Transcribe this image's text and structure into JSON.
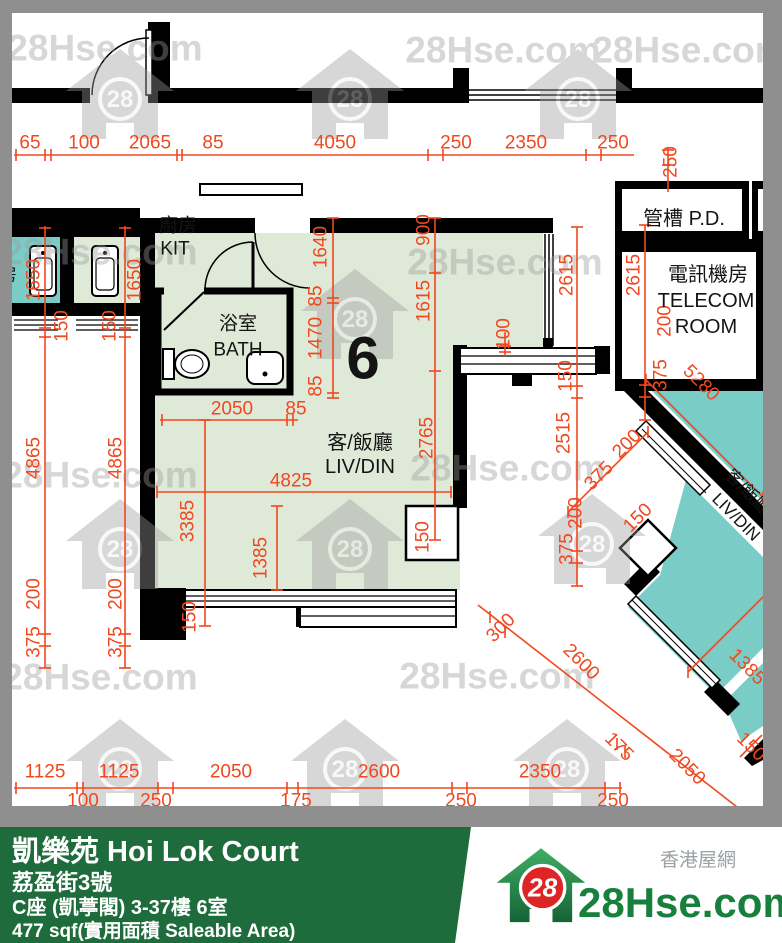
{
  "unit": {
    "number": "6"
  },
  "rooms": [
    {
      "text": "廚房",
      "x": 178,
      "y": 226,
      "size": 19
    },
    {
      "text": "KIT",
      "x": 175,
      "y": 249,
      "size": 19
    },
    {
      "text": "浴室",
      "x": 238,
      "y": 324,
      "size": 19
    },
    {
      "text": "BATH",
      "x": 238,
      "y": 350,
      "size": 19
    },
    {
      "text": "客/飯廳",
      "x": 360,
      "y": 443,
      "size": 20
    },
    {
      "text": "LIV/DIN",
      "x": 360,
      "y": 467,
      "size": 20
    },
    {
      "text": "6",
      "x": 363,
      "y": 358,
      "size": 60,
      "bold": true
    },
    {
      "text": "管槽 P.D.",
      "x": 684,
      "y": 219,
      "size": 20
    },
    {
      "text": "電訊機房",
      "x": 708,
      "y": 275,
      "size": 20
    },
    {
      "text": "TELECOM",
      "x": 706,
      "y": 301,
      "size": 20
    },
    {
      "text": "ROOM",
      "x": 706,
      "y": 327,
      "size": 20
    },
    {
      "text": "客/飯廳",
      "x": 748,
      "y": 492,
      "size": 17,
      "rot": 45
    },
    {
      "text": "LIV/DIN",
      "x": 736,
      "y": 517,
      "size": 17,
      "rot": 45
    },
    {
      "text": "房",
      "x": 8,
      "y": 275,
      "size": 18
    }
  ],
  "dimensions": [
    {
      "v": "65",
      "x": 30,
      "y": 143,
      "r": 0
    },
    {
      "v": "100",
      "x": 84,
      "y": 143,
      "r": 0
    },
    {
      "v": "2065",
      "x": 150,
      "y": 143,
      "r": 0
    },
    {
      "v": "85",
      "x": 213,
      "y": 143,
      "r": 0
    },
    {
      "v": "4050",
      "x": 335,
      "y": 143,
      "r": 0
    },
    {
      "v": "250",
      "x": 456,
      "y": 143,
      "r": 0
    },
    {
      "v": "2350",
      "x": 526,
      "y": 143,
      "r": 0
    },
    {
      "v": "250",
      "x": 613,
      "y": 143,
      "r": 0
    },
    {
      "v": "250",
      "x": 671,
      "y": 162,
      "r": -90
    },
    {
      "v": "1650",
      "x": 34,
      "y": 280,
      "r": -90
    },
    {
      "v": "150",
      "x": 62,
      "y": 326,
      "r": -90
    },
    {
      "v": "4865",
      "x": 34,
      "y": 458,
      "r": -90
    },
    {
      "v": "200",
      "x": 34,
      "y": 594,
      "r": -90
    },
    {
      "v": "375",
      "x": 34,
      "y": 642,
      "r": -90
    },
    {
      "v": "1650",
      "x": 135,
      "y": 280,
      "r": -90
    },
    {
      "v": "150",
      "x": 110,
      "y": 326,
      "r": -90
    },
    {
      "v": "4865",
      "x": 116,
      "y": 458,
      "r": -90
    },
    {
      "v": "200",
      "x": 116,
      "y": 594,
      "r": -90
    },
    {
      "v": "375",
      "x": 116,
      "y": 642,
      "r": -90
    },
    {
      "v": "1640",
      "x": 321,
      "y": 247,
      "r": -90
    },
    {
      "v": "85",
      "x": 316,
      "y": 296,
      "r": -90
    },
    {
      "v": "1470",
      "x": 316,
      "y": 338,
      "r": -90
    },
    {
      "v": "85",
      "x": 316,
      "y": 386,
      "r": -90
    },
    {
      "v": "900",
      "x": 424,
      "y": 230,
      "r": -90
    },
    {
      "v": "1615",
      "x": 424,
      "y": 301,
      "r": -90
    },
    {
      "v": "2765",
      "x": 427,
      "y": 438,
      "r": -90
    },
    {
      "v": "100",
      "x": 504,
      "y": 334,
      "r": -90
    },
    {
      "v": "2050",
      "x": 232,
      "y": 409,
      "r": 0
    },
    {
      "v": "85",
      "x": 296,
      "y": 409,
      "r": 0
    },
    {
      "v": "4825",
      "x": 291,
      "y": 481,
      "r": 0
    },
    {
      "v": "3385",
      "x": 188,
      "y": 521,
      "r": -90
    },
    {
      "v": "1385",
      "x": 261,
      "y": 558,
      "r": -90
    },
    {
      "v": "150",
      "x": 190,
      "y": 617,
      "r": -90
    },
    {
      "v": "150",
      "x": 423,
      "y": 537,
      "r": -90
    },
    {
      "v": "2615",
      "x": 567,
      "y": 275,
      "r": -90
    },
    {
      "v": "2515",
      "x": 564,
      "y": 433,
      "r": -90
    },
    {
      "v": "200",
      "x": 576,
      "y": 513,
      "r": -90
    },
    {
      "v": "375",
      "x": 567,
      "y": 549,
      "r": -90
    },
    {
      "v": "150",
      "x": 566,
      "y": 376,
      "r": -90
    },
    {
      "v": "2615",
      "x": 634,
      "y": 275,
      "r": -90
    },
    {
      "v": "200",
      "x": 665,
      "y": 321,
      "r": -90
    },
    {
      "v": "375",
      "x": 661,
      "y": 375,
      "r": -90
    },
    {
      "v": "5280",
      "x": 701,
      "y": 383,
      "r": 45
    },
    {
      "v": "300",
      "x": 501,
      "y": 628,
      "r": -45
    },
    {
      "v": "2600",
      "x": 581,
      "y": 662,
      "r": 45
    },
    {
      "v": "175",
      "x": 619,
      "y": 747,
      "r": 45
    },
    {
      "v": "2050",
      "x": 687,
      "y": 767,
      "r": 45
    },
    {
      "v": "150",
      "x": 751,
      "y": 747,
      "r": 45
    },
    {
      "v": "1385",
      "x": 747,
      "y": 667,
      "r": 45
    },
    {
      "v": "200",
      "x": 627,
      "y": 444,
      "r": -45
    },
    {
      "v": "375",
      "x": 599,
      "y": 476,
      "r": -45
    },
    {
      "v": "150",
      "x": 638,
      "y": 518,
      "r": -45
    },
    {
      "v": "1125",
      "x": 45,
      "y": 772,
      "r": 0
    },
    {
      "v": "1125",
      "x": 119,
      "y": 772,
      "r": 0
    },
    {
      "v": "2050",
      "x": 231,
      "y": 772,
      "r": 0
    },
    {
      "v": "2600",
      "x": 379,
      "y": 772,
      "r": 0
    },
    {
      "v": "2350",
      "x": 540,
      "y": 772,
      "r": 0
    },
    {
      "v": "100",
      "x": 83,
      "y": 801,
      "r": 0
    },
    {
      "v": "250",
      "x": 156,
      "y": 801,
      "r": 0
    },
    {
      "v": "175",
      "x": 296,
      "y": 801,
      "r": 0
    },
    {
      "v": "250",
      "x": 461,
      "y": 801,
      "r": 0
    },
    {
      "v": "250",
      "x": 613,
      "y": 801,
      "r": 0
    }
  ],
  "watermark": {
    "text": "28Hse.com",
    "badge": "28",
    "text_positions": [
      [
        105,
        48
      ],
      [
        503,
        50
      ],
      [
        690,
        50
      ],
      [
        100,
        252
      ],
      [
        505,
        262
      ],
      [
        100,
        475
      ],
      [
        508,
        468
      ],
      [
        100,
        677
      ],
      [
        497,
        676
      ]
    ],
    "house_positions": [
      [
        120,
        95
      ],
      [
        350,
        95
      ],
      [
        578,
        95
      ],
      [
        355,
        315
      ],
      [
        120,
        545
      ],
      [
        350,
        545
      ],
      [
        592,
        540
      ],
      [
        120,
        765
      ],
      [
        345,
        765
      ],
      [
        567,
        765
      ]
    ]
  },
  "footer": {
    "estate": "凱樂苑 Hoi Lok Court",
    "street": "荔盈街3號",
    "block_floor_flat": "C座 (凱葶閣) 3-37樓 6室",
    "area": "477 sqf(實用面積 Saleable Area)",
    "brand_site": "28Hse.com",
    "brand_cn": "香港屋網",
    "brand_badge": "28"
  },
  "colors": {
    "dimension_red": "#f0481f",
    "unit_floor_green": "#dfe9d8",
    "neighbor_teal": "#7accc7",
    "frame_gray": "#8f8f8f",
    "footer_green": "#1e6b3c",
    "logo_red": "#dd2525",
    "logo_text_green": "#17803c"
  }
}
